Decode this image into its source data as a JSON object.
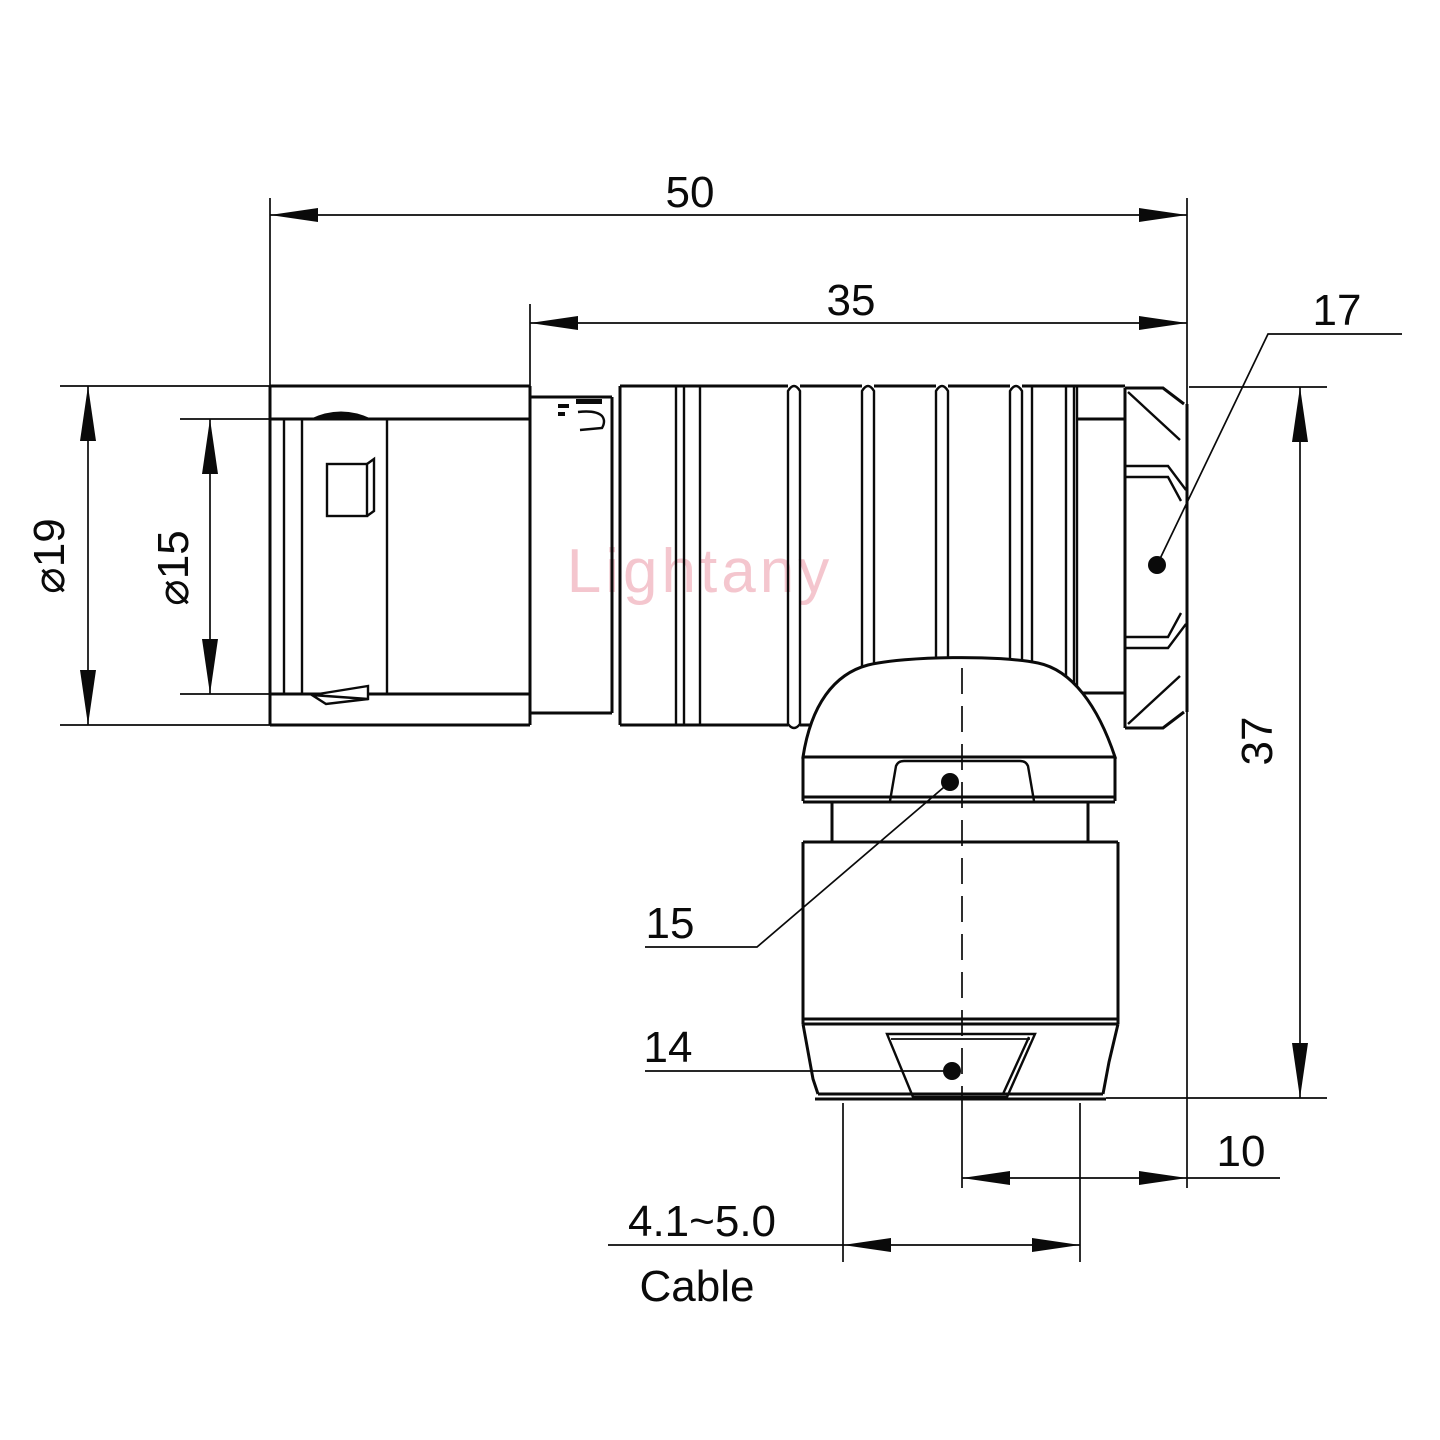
{
  "watermark": {
    "text": "Lightany"
  },
  "dims": {
    "total_length": "50",
    "body_length": "35",
    "hex_width": "17",
    "outer_diameter": "⌀19",
    "inner_diameter": "⌀15",
    "height": "37",
    "nut_flats": "15",
    "clamp_flats": "14",
    "axis_offset": "10",
    "cable_range": "4.1~5.0",
    "cable_label": "Cable"
  },
  "colors": {
    "line": "#0a0a0a",
    "background": "#ffffff",
    "watermark": "#f2b9c3"
  }
}
